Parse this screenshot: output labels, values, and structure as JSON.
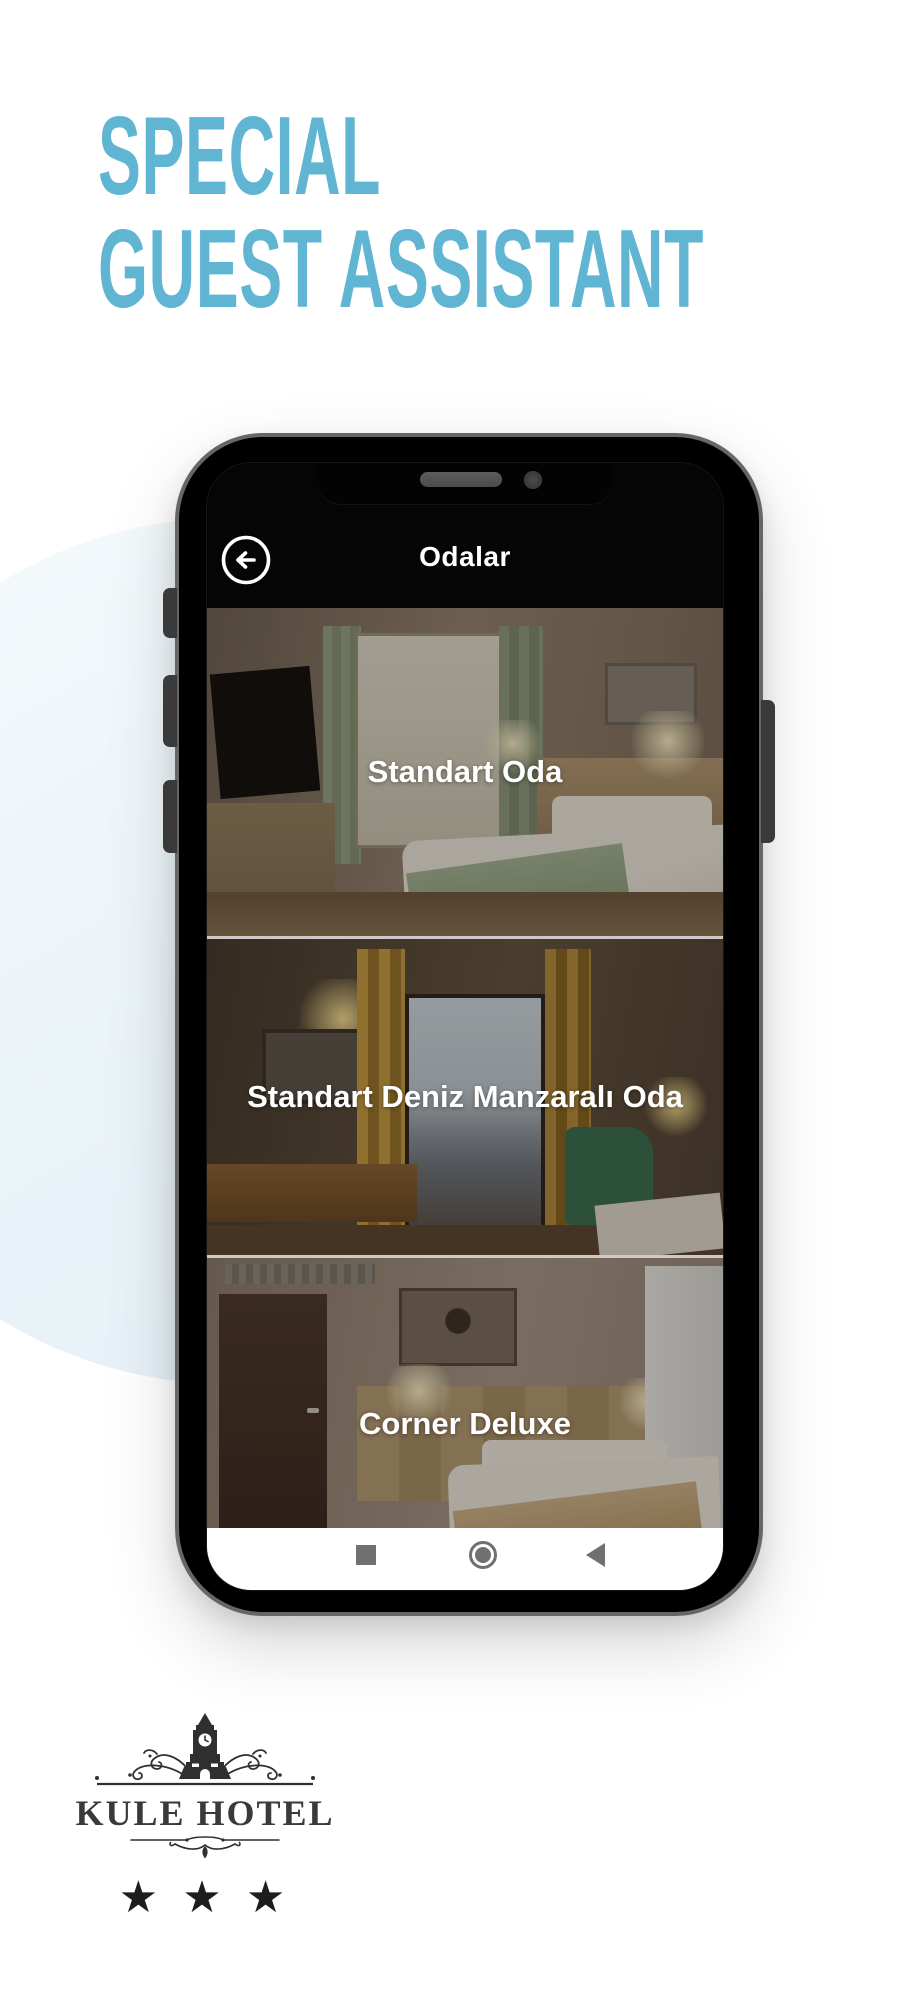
{
  "colors": {
    "accent": "#5fb5d2",
    "phone_frame": "#666666",
    "nav_icon_gray": "#707070",
    "logo_ink": "#3a3a3a",
    "background_circle": "#eaf3f8"
  },
  "hero": {
    "line1": "SPECIAL",
    "line2": "GUEST ASSISTANT"
  },
  "phone": {
    "app_bar": {
      "title": "Odalar",
      "back_icon": "arrow-left-circle"
    },
    "rooms": [
      {
        "label": "Standart Oda"
      },
      {
        "label": "Standart Deniz Manzaralı Oda"
      },
      {
        "label": "Corner Deluxe"
      }
    ],
    "nav_bar": {
      "recents_icon": "square",
      "home_icon": "circle",
      "back_icon": "triangle-left"
    }
  },
  "logo": {
    "hotel_name": "KULE HOTEL",
    "stars": "★ ★ ★",
    "emblem": "clock-tower"
  }
}
